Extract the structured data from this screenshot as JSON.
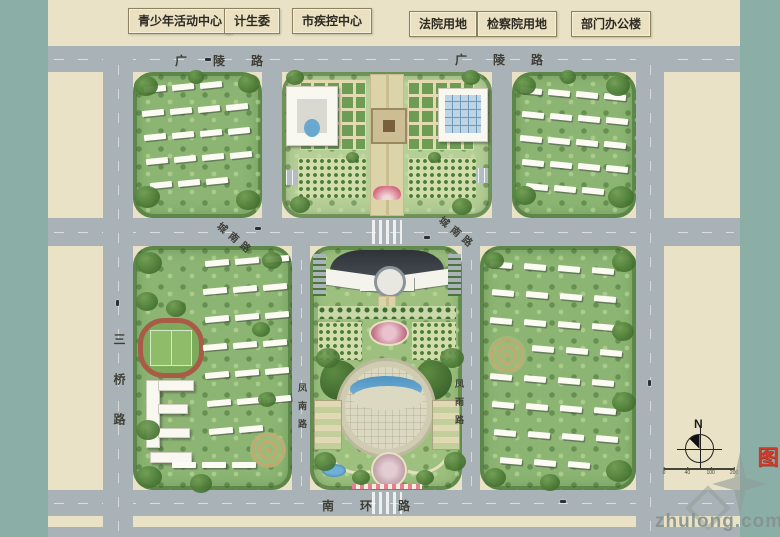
{
  "facility_labels": [
    {
      "label": "青少年活动中心"
    },
    {
      "label": "计生委"
    },
    {
      "label": "市疾控中心"
    },
    {
      "label": "法院用地"
    },
    {
      "label": "检察院用地"
    },
    {
      "label": "部门办公楼"
    }
  ],
  "roads": {
    "guangling_west": "广陵路",
    "guangling_east": "广陵路",
    "chengnan_west": "城南路",
    "chengnan_east": "城南路",
    "sanqiao": "三桥路",
    "fengnan": "凤南路",
    "fengyu": "凤雨路",
    "nanhuan": "南环路"
  },
  "compass": {
    "north_label": "N"
  },
  "scale_bar": {
    "tick_labels": [
      "0",
      "40",
      "100",
      "200"
    ]
  },
  "watermark": {
    "text": "zhulong.com"
  },
  "drawing_title": {
    "text": "总平面图"
  },
  "colors": {
    "road_gray": "#a9b2b6",
    "parcel_beige": "#e9e2c6",
    "greenery": "#8cb573",
    "margin_teal": "#8bafa6",
    "water_blue": "#6aa9cf",
    "title_red": "#cf3a2a"
  }
}
